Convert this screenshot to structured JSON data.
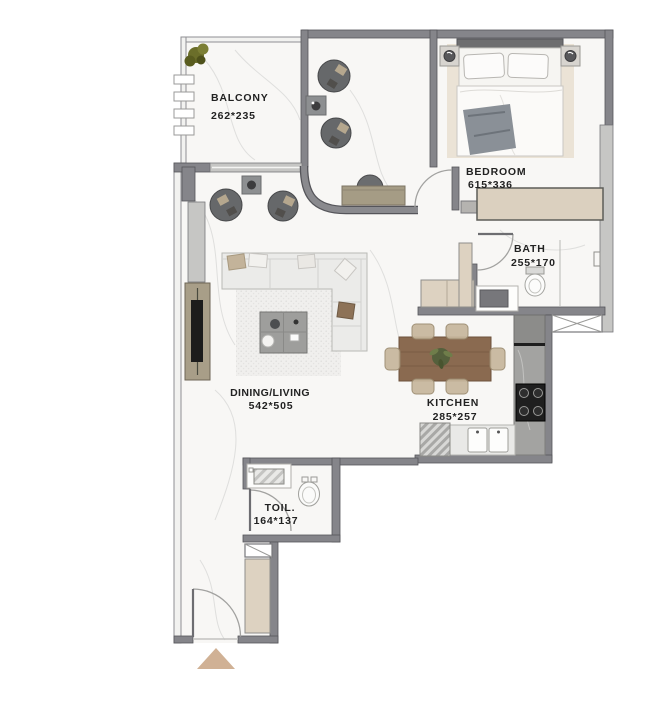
{
  "plan": {
    "title": "apartment-floor-plan",
    "rooms": {
      "balcony": {
        "name": "BALCONY",
        "dims": "262*235"
      },
      "bedroom": {
        "name": "BEDROOM",
        "dims": "615*336"
      },
      "bath": {
        "name": "BATH",
        "dims": "255*170"
      },
      "dining_living": {
        "name": "DINING/LIVING",
        "dims": "542*505"
      },
      "kitchen": {
        "name": "KITCHEN",
        "dims": "285*257"
      },
      "toilet": {
        "name": "TOIL.",
        "dims": "164*137"
      }
    },
    "icons": {
      "entry_arrow": "triangle-up",
      "shaft_cross": "x-cross",
      "shaft_diagonal": "diagonal-line"
    },
    "colors": {
      "wall": "#85858a",
      "wall_outline": "#55555a",
      "window": "#c6c6c4",
      "floor": "#f8f7f5",
      "beige_cabinet": "#ddd2c1",
      "bedroom_rug": "#ebe3d6",
      "wood_table": "#8a6a50",
      "tan_chair": "#c7b79d",
      "entry_arrow": "#d0b195",
      "stove": "#1f1f1f",
      "plant": "#6b6e2a",
      "label_text": "#222222"
    }
  }
}
